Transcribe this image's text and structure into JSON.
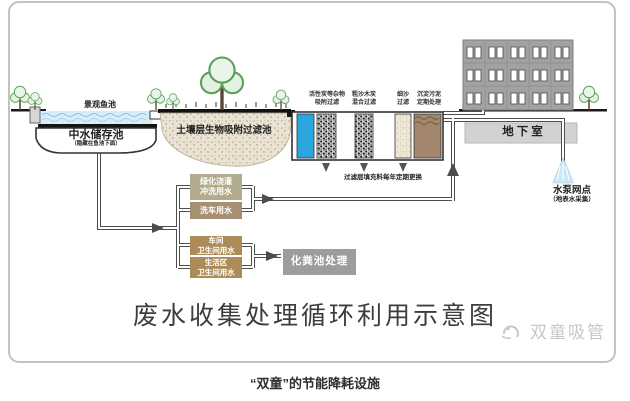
{
  "title": "废水收集处理循环利用示意图",
  "caption": "“双童”的节能降耗设施",
  "watermark": "双童吸管",
  "labels": {
    "fish_pond": "景观鱼池",
    "storage_pool": "中水储存池",
    "storage_pool_note": "（隐藏在鱼池下面）",
    "soil_filter": "土壤层生物吸附过滤池",
    "filter_note": "过滤层填充料每年定期更换",
    "basement": "地下室",
    "pump_point": "水泵网点",
    "pump_point_note": "（地表水采集）",
    "septic": "化粪池处理"
  },
  "filter_columns": [
    {
      "line1": "活性炭等杂物",
      "line2": "吸附过滤"
    },
    {
      "line1": "粗沙木炭",
      "line2": "混合过滤"
    },
    {
      "line1": "细沙",
      "line2": "过滤"
    },
    {
      "line1": "沉淀污泥",
      "line2": "定期处理"
    }
  ],
  "use_boxes": [
    {
      "line1": "绿化浇灌",
      "line2": "冲洗用水"
    },
    {
      "line1": "洗车用水"
    },
    {
      "line1": "车间",
      "line2": "卫生间用水"
    },
    {
      "line1": "生活区",
      "line2": "卫生间用水"
    }
  ],
  "colors": {
    "pond_water": "#d8ecf7",
    "column_water": "#2aa7df",
    "soil": "#eae2d2",
    "sludge_brown": "#a3876d",
    "building_gray": "#a2a2a2",
    "basement_gray": "#d2d2d2",
    "box_khaki": "#b2ab8d",
    "box_brown": "#a68f73",
    "box_gold": "#ab8c58",
    "septic_gray": "#9d9d9d",
    "pipe": "#4d4d4d",
    "tree_green": "#5a9e5a",
    "frame": "#c2c2c2"
  }
}
